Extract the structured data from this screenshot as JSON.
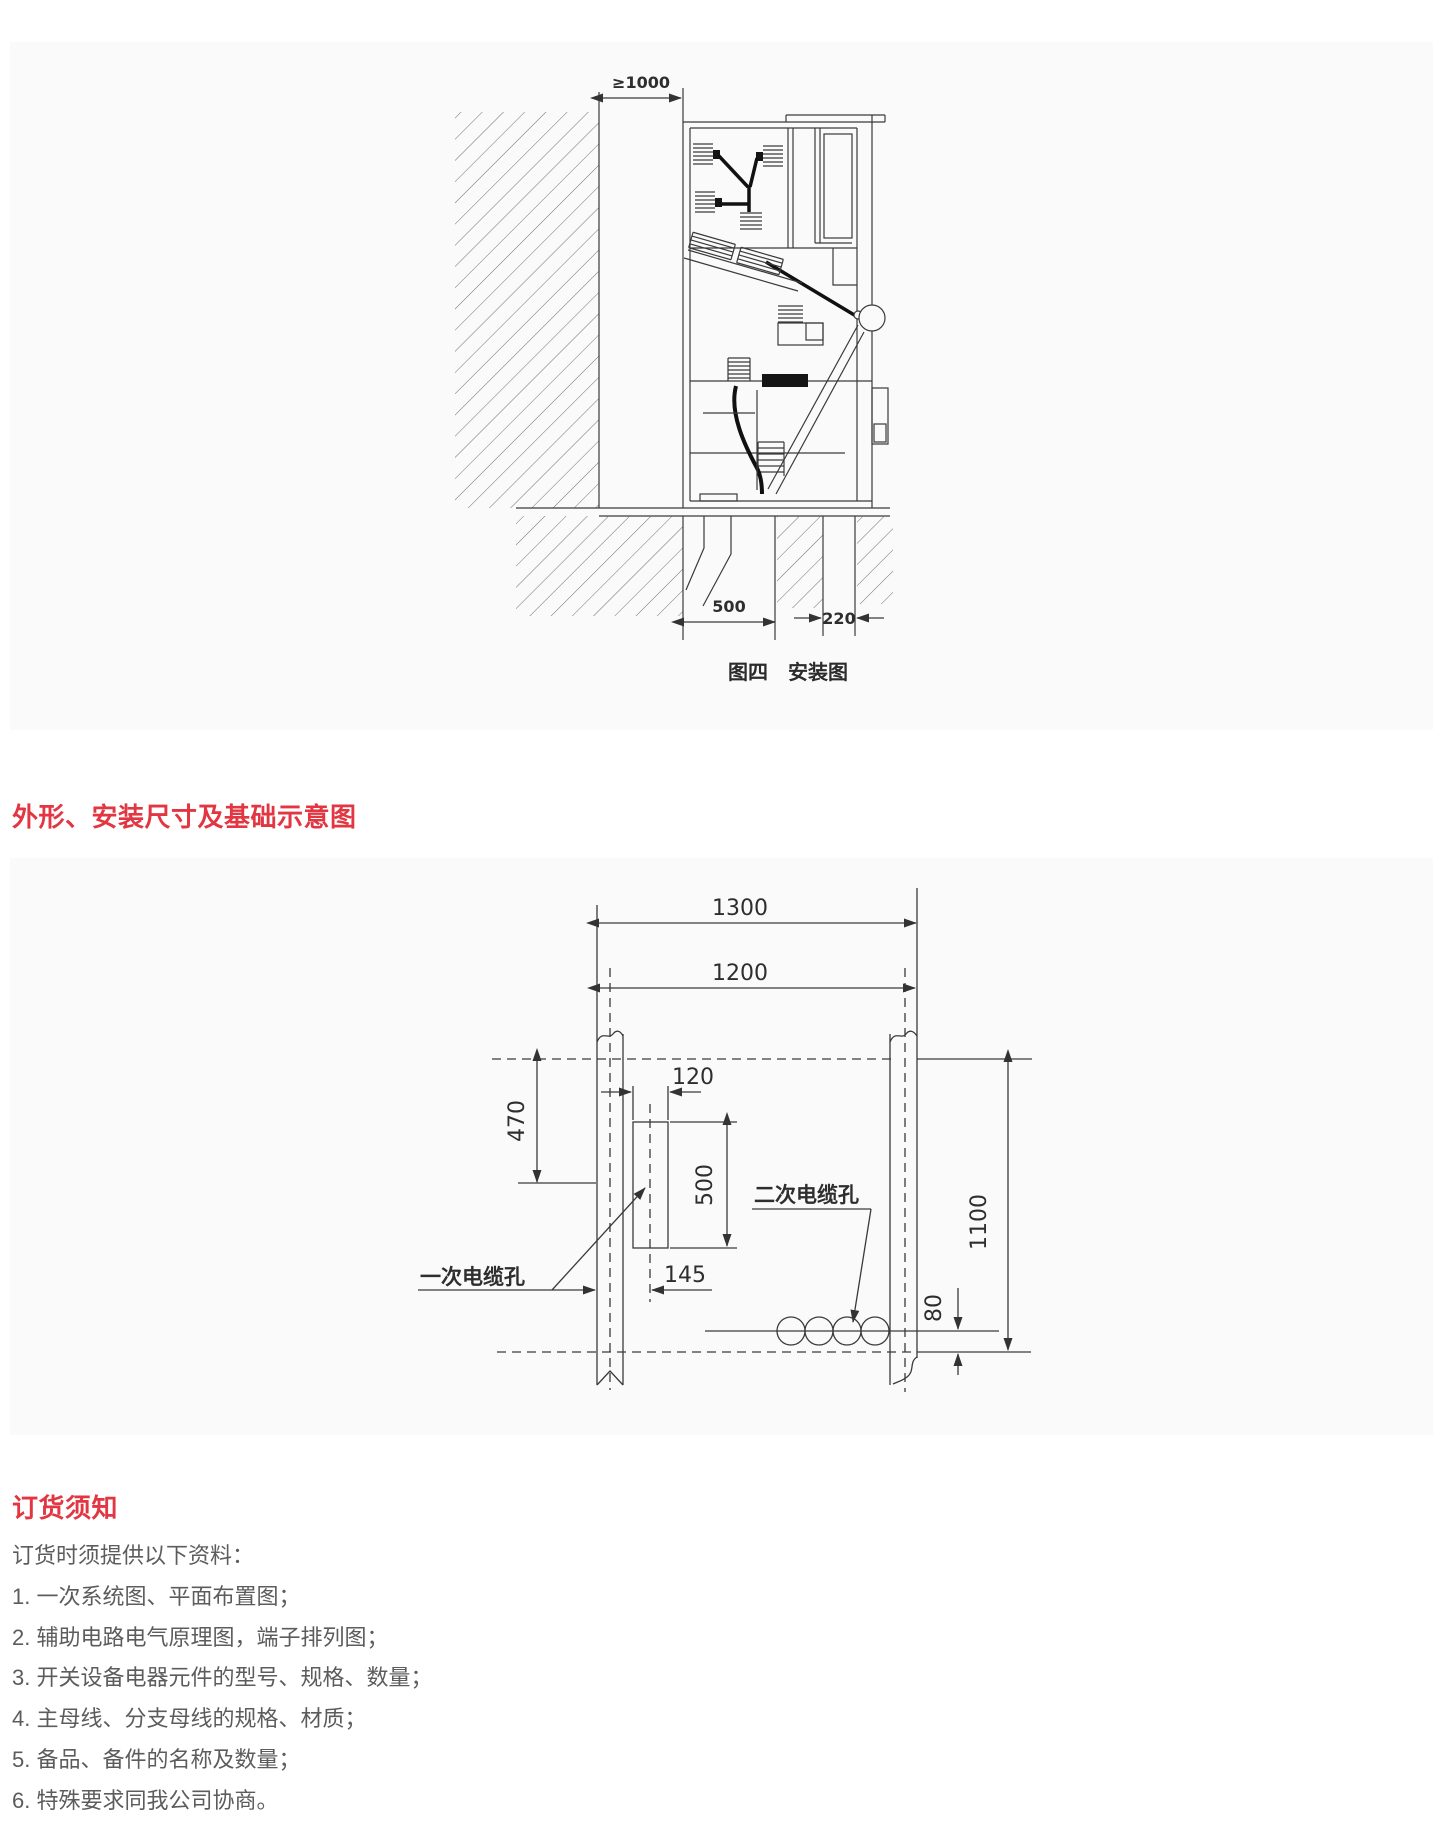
{
  "page": {
    "background": "#ffffff",
    "panel_background": "#fafafa",
    "accent_red": "#e23642",
    "line_color": "#3a3a3a",
    "body_text_color": "#5c5c5c"
  },
  "figure4": {
    "caption": "图四　安装图",
    "wall_clearance": "≥1000",
    "front_trench_width": "500",
    "rear_trench_width": "220"
  },
  "outline": {
    "heading": "外形、安装尺寸及基础示意图",
    "overall_width": "1300",
    "foundation_width": "1200",
    "front_offset": "470",
    "hole_width": "120",
    "hole_length": "500",
    "hole_center_offset": "145",
    "foundation_depth": "1100",
    "secondary_hole_offset": "80",
    "primary_label": "一次电缆孔",
    "secondary_label": "二次电缆孔"
  },
  "ordering": {
    "heading": "订货须知",
    "intro": "订货时须提供以下资料：",
    "items": [
      "1. 一次系统图、平面布置图；",
      "2. 辅助电路电气原理图，端子排列图；",
      "3. 开关设备电器元件的型号、规格、数量；",
      "4. 主母线、分支母线的规格、材质；",
      "5. 备品、备件的名称及数量；",
      "6. 特殊要求同我公司协商。"
    ]
  }
}
